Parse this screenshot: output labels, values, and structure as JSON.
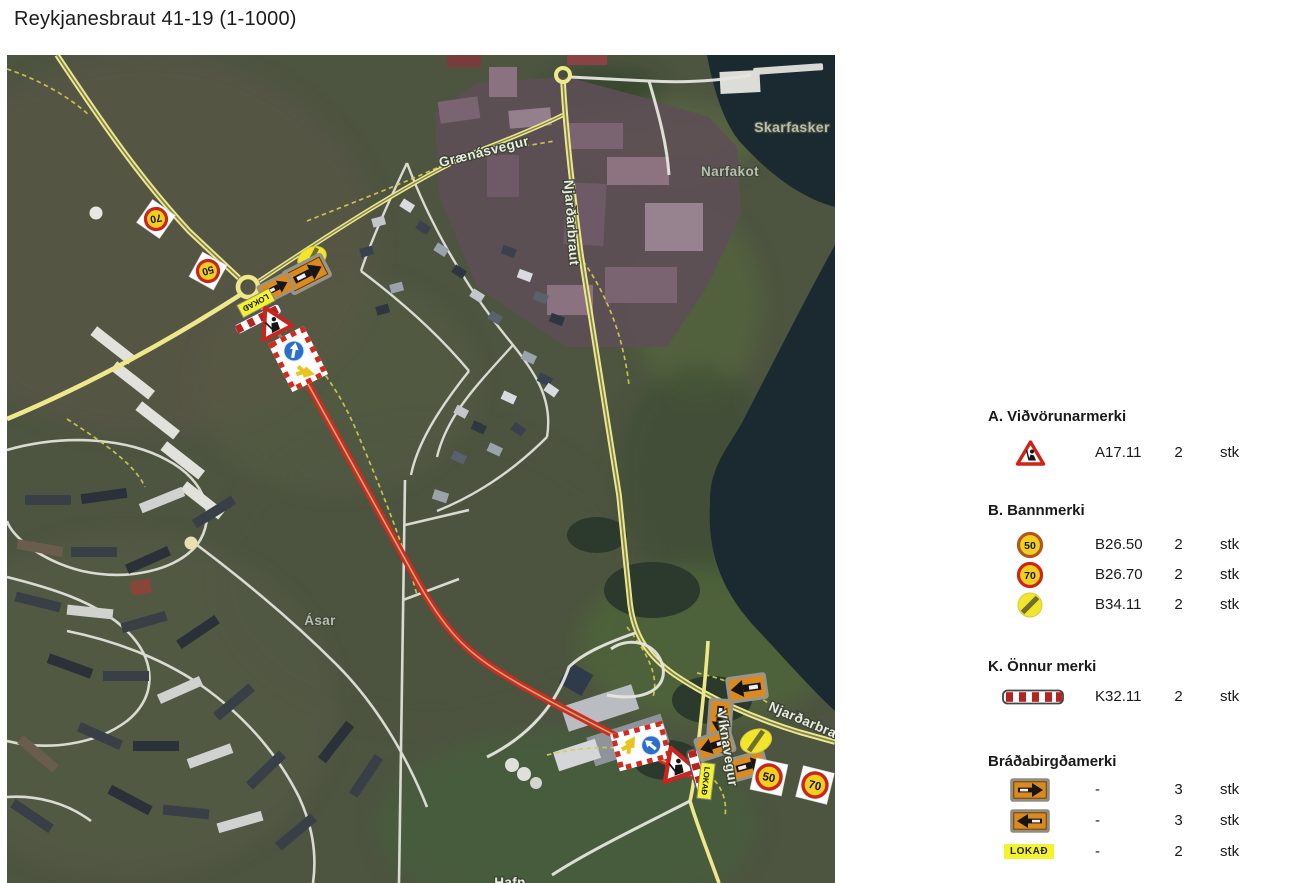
{
  "title": "Reykjanesbraut 41-19 (1-1000)",
  "map": {
    "place_labels": {
      "graenasvegur": "Grænásvegur",
      "njardarbraut": "Njarðarbraut",
      "skarfasker": "Skarfasker",
      "narfakot": "Narfakot",
      "asar": "Ásar",
      "viknavegur": "Víknavegur",
      "njardarbraut_south": "Njarðarbra",
      "hafn": "Hafn"
    },
    "sign_texts": {
      "speed50": "50",
      "speed70": "70",
      "lokad": "LOKAÐ"
    }
  },
  "legend": {
    "sections": [
      {
        "heading": "A. Viðvörunarmerki",
        "rows": [
          {
            "icon": "roadwork-sign-icon",
            "code": "A17.11",
            "qty": "2",
            "unit": "stk"
          }
        ]
      },
      {
        "heading": "B. Bannmerki",
        "rows": [
          {
            "icon": "speed-50-sign-icon",
            "code": "B26.50",
            "qty": "2",
            "unit": "stk"
          },
          {
            "icon": "speed-70-sign-icon",
            "code": "B26.70",
            "qty": "2",
            "unit": "stk"
          },
          {
            "icon": "end-restriction-sign-icon",
            "code": "B34.11",
            "qty": "2",
            "unit": "stk"
          }
        ]
      },
      {
        "heading": "K. Önnur merki",
        "rows": [
          {
            "icon": "barrier-board-icon",
            "code": "K32.11",
            "qty": "2",
            "unit": "stk"
          }
        ]
      },
      {
        "heading": "Bráðabirgðamerki",
        "rows": [
          {
            "icon": "arrow-right-sign-icon",
            "code": "-",
            "qty": "3",
            "unit": "stk"
          },
          {
            "icon": "arrow-left-sign-icon",
            "code": "-",
            "qty": "3",
            "unit": "stk"
          },
          {
            "icon": "lokad-sign-icon",
            "code": "-",
            "qty": "2",
            "unit": "stk"
          }
        ]
      }
    ]
  },
  "colors": {
    "route_red": "#d8281a",
    "road_yellow": "#efe88a",
    "sign_orange": "#db8a1f",
    "sign_yellow": "#f2cf1d",
    "sign_red": "#c9241d",
    "lokad_yellow": "#f4f32b"
  }
}
